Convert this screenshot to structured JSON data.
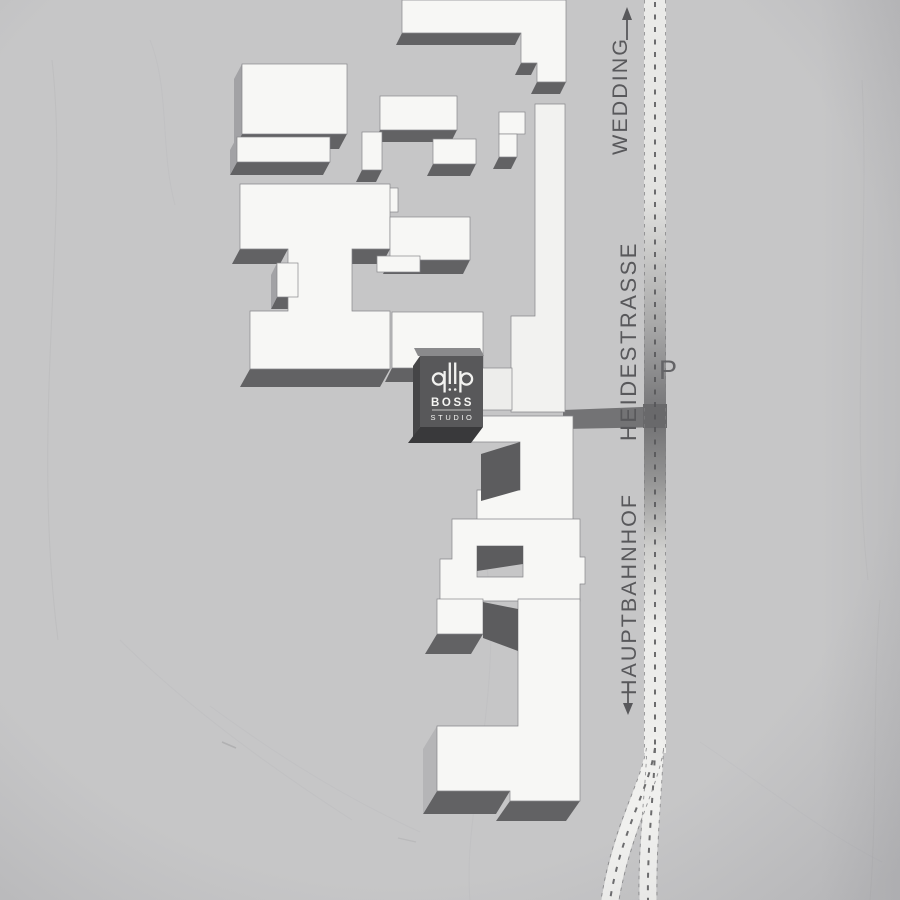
{
  "canvas": {
    "background": "#c6c6c7"
  },
  "road": {
    "street_name": "HEIDESTRASSE",
    "north_destination": "WEDDING",
    "south_destination": "HAUPTBAHNHOF",
    "parking_label": "P",
    "label_color": "#58585b",
    "surface_light": "#f0f0ee",
    "surface_dark": "#737375",
    "centerline_color": "#555557",
    "north_arrow_icon": "arrow-up",
    "south_arrow_icon": "arrow-down"
  },
  "buildings": {
    "fill": "#f7f7f5",
    "side_shade": "#626264",
    "outline": "#87878a"
  },
  "logo": {
    "title": "BOSS",
    "subtitle": "STUDIO",
    "monogram": "qllp-mark",
    "background": "#58585a",
    "text_color": "#f5f5f3"
  }
}
